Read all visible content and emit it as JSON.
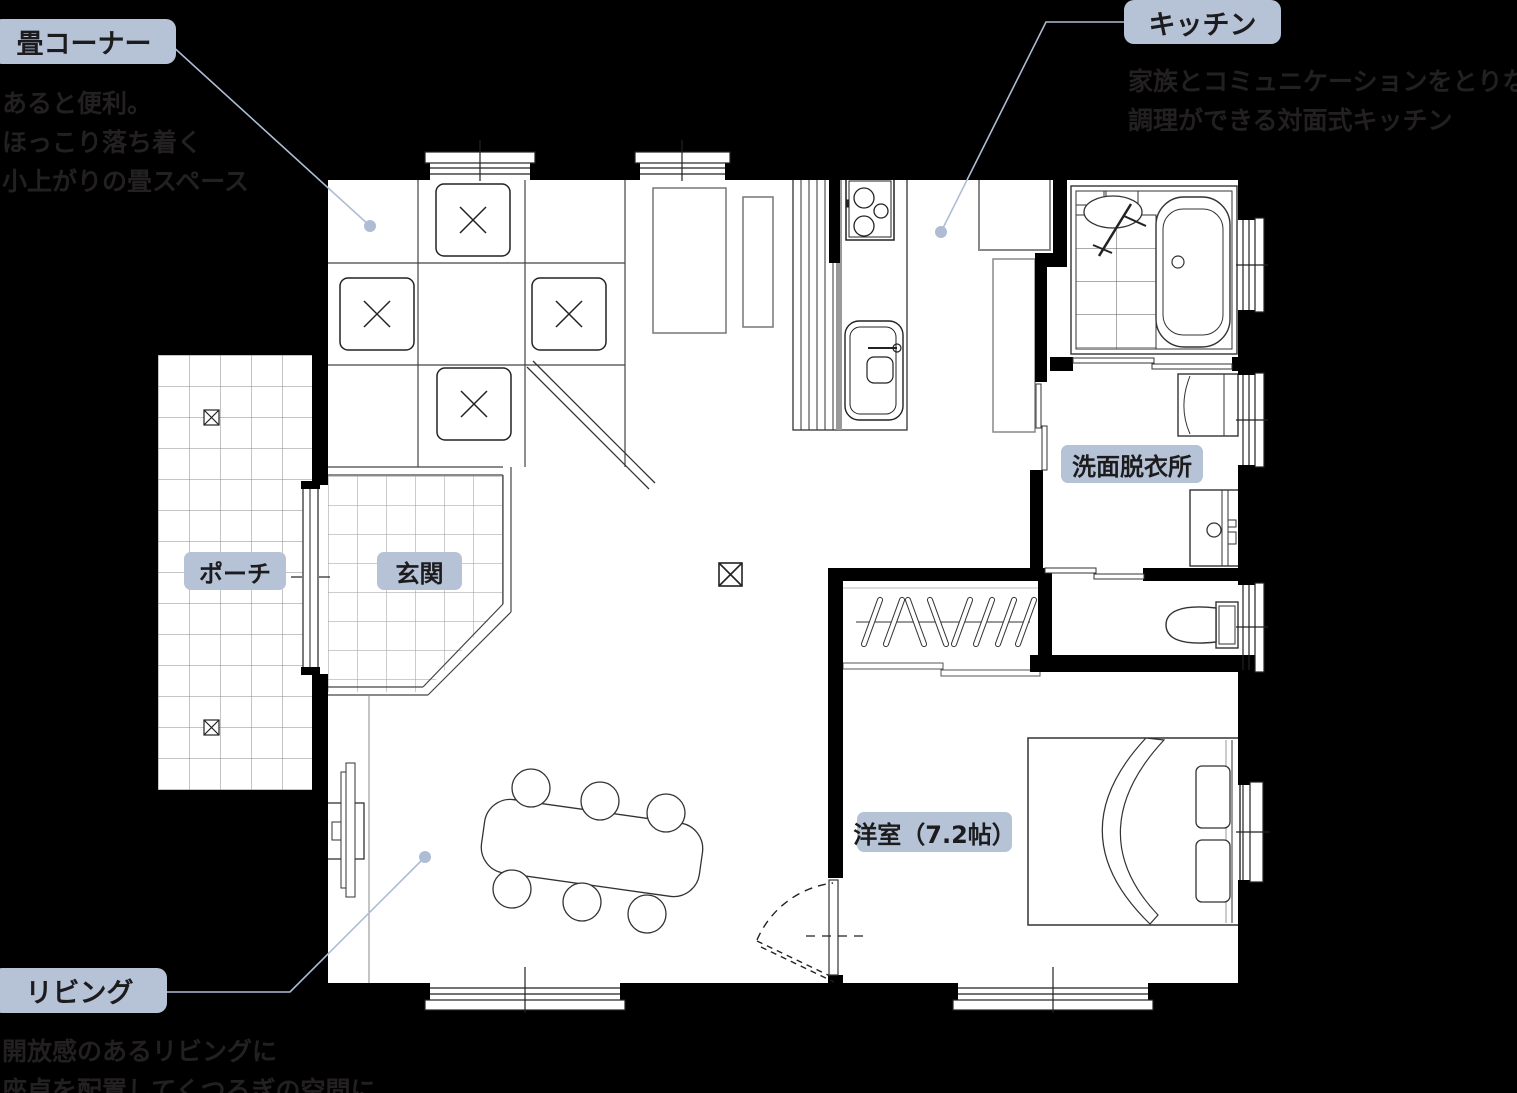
{
  "page": {
    "background": "#000000",
    "width": 1517,
    "height": 1093
  },
  "colors": {
    "label_bg": "#b6c2d6",
    "label_text": "#1c1c1e",
    "note_text": "#232022",
    "leader_line": "#aebdd4",
    "wall": "#000000",
    "floor": "#ffffff"
  },
  "labels": {
    "tatami_corner": "畳コーナー",
    "kitchen": "キッチン",
    "washroom": "洗面脱衣所",
    "porch": "ポーチ",
    "entrance": "玄関",
    "bedroom": "洋室（7.2帖）",
    "living": "リビング"
  },
  "notes": {
    "tatami_corner": [
      "あると便利。",
      "ほっこり落ち着く",
      "小上がりの畳スペース"
    ],
    "kitchen": [
      "家族とコミュニケーションをとりながら",
      "調理ができる対面式キッチン"
    ],
    "living": [
      "開放感のあるリビングに",
      "座卓を配置してくつろぎの空間に"
    ]
  }
}
